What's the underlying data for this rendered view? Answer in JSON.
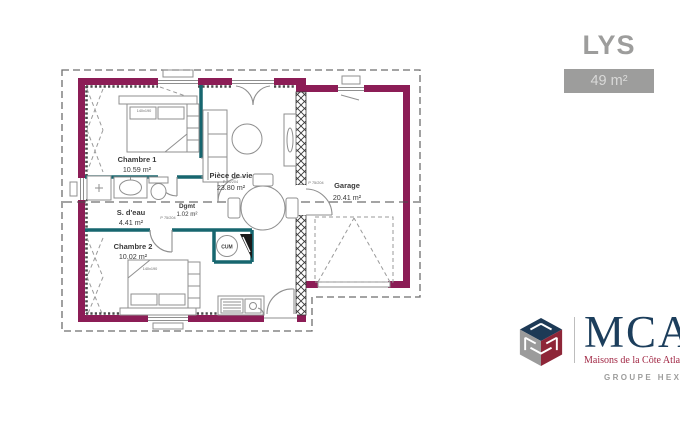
{
  "header": {
    "title": "LYS",
    "area_badge": "49 m²"
  },
  "plan": {
    "rooms": [
      {
        "name": "Chambre 1",
        "area": "10.59 m²"
      },
      {
        "name": "S. d'eau",
        "area": "4.41 m²"
      },
      {
        "name": "Dgmt",
        "area": "1.02 m²"
      },
      {
        "name": "Chambre 2",
        "area": "10.02 m²"
      },
      {
        "name": "Pièce de vie",
        "area": "23.80 m²"
      },
      {
        "name": "Garage",
        "area": "20.41 m²"
      }
    ],
    "labels": {
      "water_heater": "CUM",
      "door_size": "P 75/204",
      "bed_size": "140x190"
    },
    "colors": {
      "exterior_wall": "#8c1d56",
      "interior_wall": "#17666f",
      "title_gray": "#9d9d9c",
      "brand_blue": "#1c3e5c",
      "brand_red": "#a12744"
    }
  },
  "logo": {
    "brand": "MCA",
    "tagline": "Maisons de la Côte Atlantique",
    "group": "GROUPE HEXAOM"
  }
}
